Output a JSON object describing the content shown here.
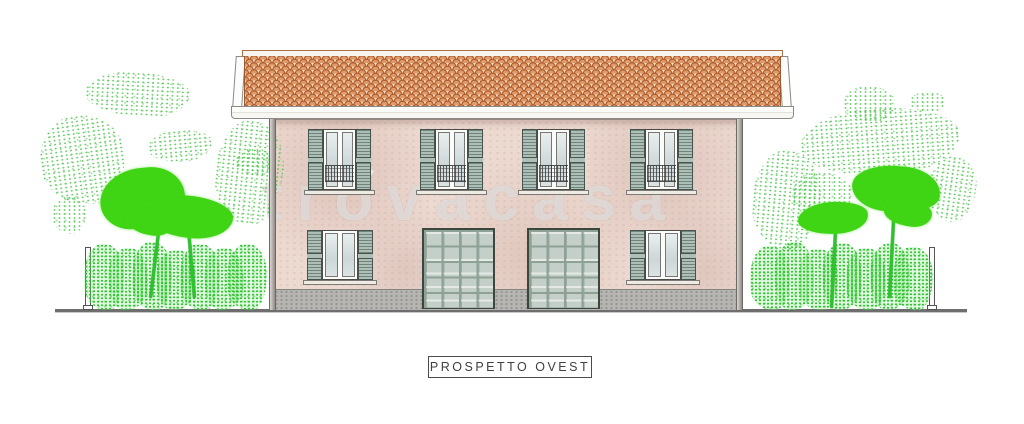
{
  "drawing": {
    "description": "Architectural west elevation drawing of a two-story duplex house with tiled roof, shuttered windows, two garage doors and garden vegetation",
    "type": "elevation-drawing"
  },
  "title_block": {
    "label": "PROSPETTO OVEST"
  },
  "watermark": {
    "text": "trovacasa"
  },
  "building": {
    "floors": 2,
    "upper_windows": 4,
    "ground_windows": 2,
    "garage_doors": 2,
    "garage_panel_grid": "4x5",
    "downspouts": 2
  },
  "vegetation": {
    "left": {
      "trees": 2,
      "hedge": true,
      "fence_post": true
    },
    "right": {
      "trees": 2,
      "hedge": true,
      "fence_post": true
    }
  },
  "colors": {
    "roof_tile": "#e09a66",
    "roof_tile_outline": "#b05f35",
    "facade": "#ecd9d0",
    "shutters": "#aebfb7",
    "garage": "#c3cfc8",
    "plinth": "#b6b5b1",
    "foliage_solid": "#3fd414",
    "ground_line": "#6e6e6e",
    "title_text": "#3f3f3f"
  }
}
